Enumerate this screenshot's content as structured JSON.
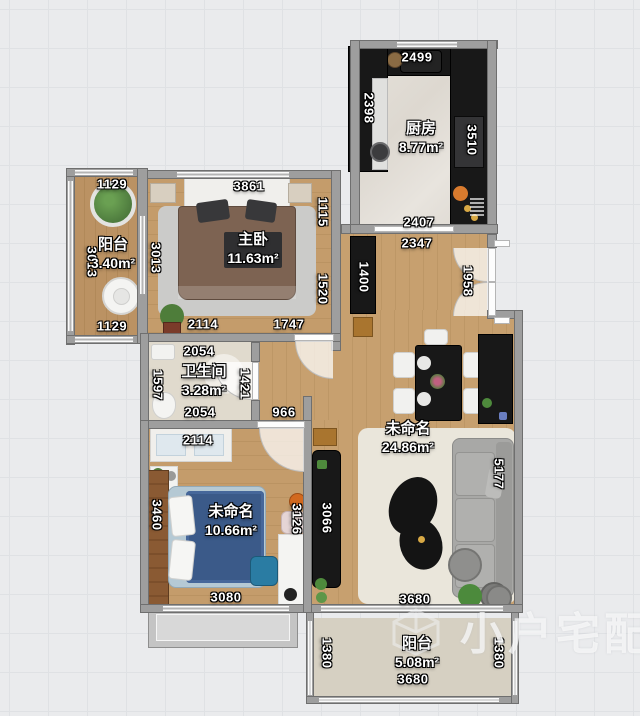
{
  "watermark": {
    "text": "小户宅配"
  },
  "rooms": [
    {
      "id": "kitchen",
      "name": "厨房",
      "area": "8.77m²",
      "x": 421,
      "y": 138
    },
    {
      "id": "balcony-left",
      "name": "阳台",
      "area": "3.40m²",
      "x": 113,
      "y": 254
    },
    {
      "id": "master-bedroom",
      "name": "主卧",
      "area": "11.63m²",
      "x": 253,
      "y": 249
    },
    {
      "id": "bathroom",
      "name": "卫生间",
      "area": "3.28m²",
      "x": 204,
      "y": 381
    },
    {
      "id": "living-room",
      "name": "未命名",
      "area": "24.86m²",
      "x": 408,
      "y": 438
    },
    {
      "id": "bedroom-2",
      "name": "未命名",
      "area": "10.66m²",
      "x": 231,
      "y": 521
    },
    {
      "id": "balcony-bottom",
      "name": "阳台",
      "area": "5.08m²",
      "x": 417,
      "y": 653
    }
  ],
  "dimensions": [
    {
      "text": "2499",
      "x": 417,
      "y": 57,
      "rot": 0
    },
    {
      "text": "2398",
      "x": 369,
      "y": 108,
      "rot": 90
    },
    {
      "text": "3510",
      "x": 472,
      "y": 140,
      "rot": 90
    },
    {
      "text": "2407",
      "x": 419,
      "y": 222,
      "rot": 0
    },
    {
      "text": "2347",
      "x": 417,
      "y": 243,
      "rot": 0
    },
    {
      "text": "1400",
      "x": 364,
      "y": 277,
      "rot": 90
    },
    {
      "text": "1958",
      "x": 468,
      "y": 281,
      "rot": 90
    },
    {
      "text": "1129",
      "x": 112,
      "y": 184,
      "rot": 0
    },
    {
      "text": "3013",
      "x": 92,
      "y": 262,
      "rot": 90
    },
    {
      "text": "1129",
      "x": 112,
      "y": 326,
      "rot": 0
    },
    {
      "text": "3861",
      "x": 249,
      "y": 186,
      "rot": 0
    },
    {
      "text": "3013",
      "x": 156,
      "y": 258,
      "rot": 90
    },
    {
      "text": "1115",
      "x": 323,
      "y": 212,
      "rot": 90
    },
    {
      "text": "1520",
      "x": 323,
      "y": 289,
      "rot": 90
    },
    {
      "text": "2114",
      "x": 203,
      "y": 324,
      "rot": 0
    },
    {
      "text": "1747",
      "x": 289,
      "y": 324,
      "rot": 0
    },
    {
      "text": "2054",
      "x": 199,
      "y": 351,
      "rot": 0
    },
    {
      "text": "1597",
      "x": 158,
      "y": 385,
      "rot": 90
    },
    {
      "text": "1421",
      "x": 245,
      "y": 384,
      "rot": 90
    },
    {
      "text": "2054",
      "x": 200,
      "y": 412,
      "rot": 0
    },
    {
      "text": "966",
      "x": 284,
      "y": 412,
      "rot": 0
    },
    {
      "text": "2114",
      "x": 198,
      "y": 440,
      "rot": 0
    },
    {
      "text": "3460",
      "x": 157,
      "y": 515,
      "rot": 90
    },
    {
      "text": "3126",
      "x": 297,
      "y": 519,
      "rot": 90
    },
    {
      "text": "3080",
      "x": 226,
      "y": 597,
      "rot": 0
    },
    {
      "text": "3066",
      "x": 327,
      "y": 518,
      "rot": 90
    },
    {
      "text": "5177",
      "x": 499,
      "y": 474,
      "rot": 90
    },
    {
      "text": "3680",
      "x": 415,
      "y": 599,
      "rot": 0
    },
    {
      "text": "1380",
      "x": 327,
      "y": 653,
      "rot": 90
    },
    {
      "text": "1380",
      "x": 499,
      "y": 653,
      "rot": 90
    },
    {
      "text": "3680",
      "x": 413,
      "y": 679,
      "rot": 0
    }
  ],
  "colors": {
    "wall": "#9e9e9e",
    "wood_floor": "#c49c6b",
    "kitchen_floor": "#e2ded7",
    "bath_floor": "#e0dacd",
    "balcony_floor": "#d6d0c2",
    "black_furniture": "#181818",
    "master_bed": "#7d6352",
    "bed2_duvet": "#3b5a89",
    "sofa": "#a8a8a6",
    "label_text": "#ffffff",
    "background": "#eaebed"
  }
}
